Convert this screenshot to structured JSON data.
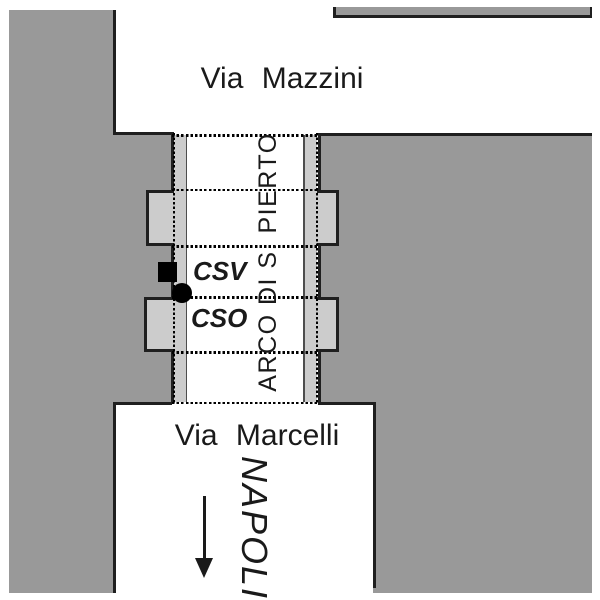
{
  "map": {
    "type": "street-map-sketch",
    "colors": {
      "background": "#ffffff",
      "block_gray": "#999999",
      "annex_light_gray": "#cccccc",
      "outline_dark": "#1f1f1f",
      "dotted_line": "#000000",
      "marker_black": "#000000",
      "text": "#1a1a1a"
    },
    "streets": {
      "via_mazzini": {
        "label": "Via Mazzini",
        "orientation": "horizontal-top"
      },
      "via_marcelli": {
        "label": "Via Marcelli",
        "orientation": "horizontal-bottom"
      },
      "arco": {
        "label": "ARCO DI S. PIERTO",
        "orientation": "vertical"
      }
    },
    "destination": {
      "label": "NAPOLI",
      "direction": "south-arrow-down"
    },
    "markers": {
      "csv": {
        "label": "CSV",
        "shape": "black-square"
      },
      "cso": {
        "label": "CSO",
        "shape": "black-dot"
      }
    }
  }
}
